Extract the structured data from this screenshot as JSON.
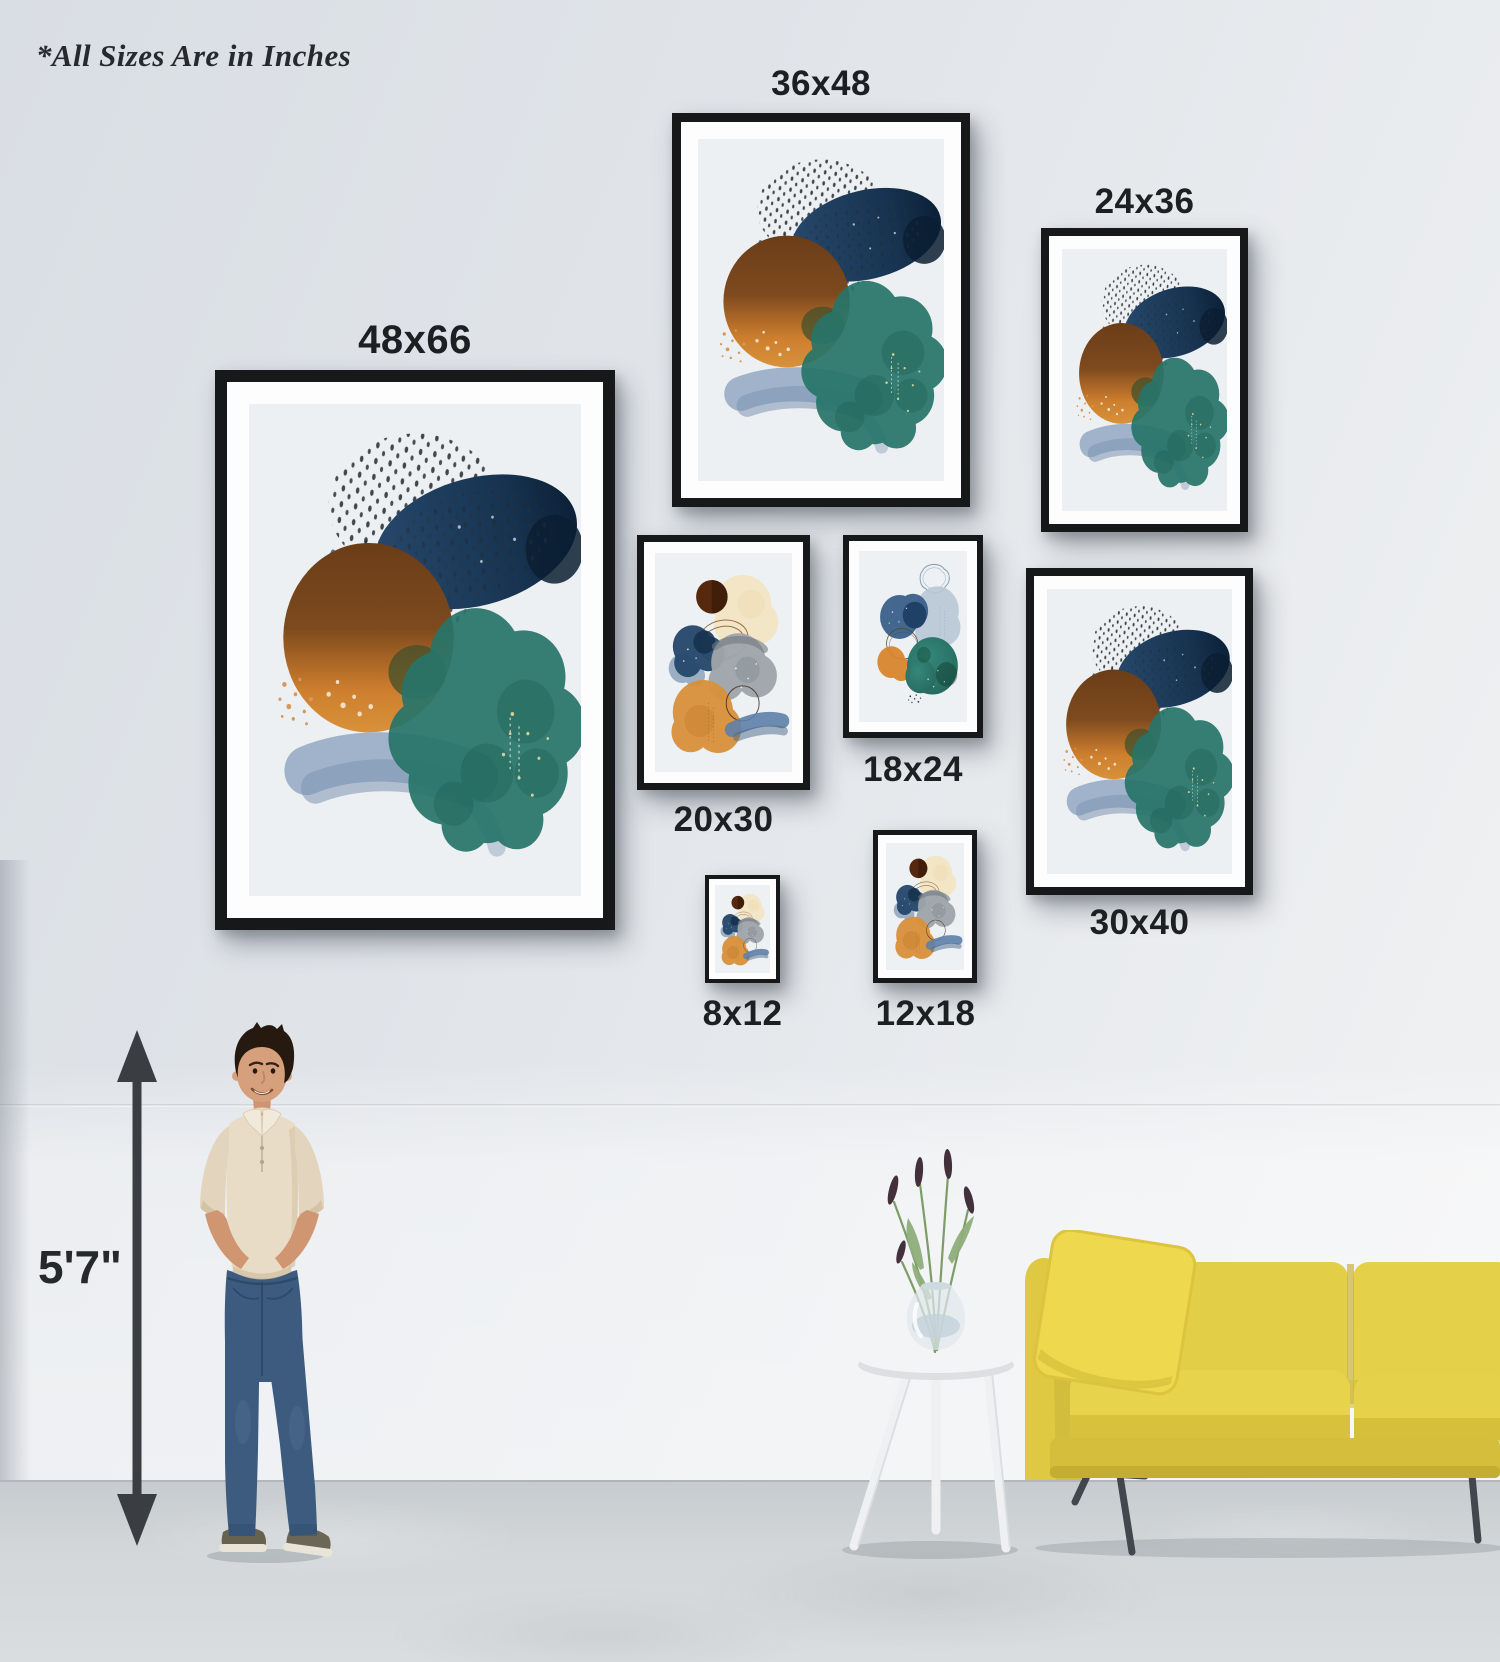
{
  "note": "*All Sizes Are in Inches",
  "frames": [
    {
      "size_label": "48x66",
      "label_position": "above",
      "artwork": "abstract-navy-brown-teal"
    },
    {
      "size_label": "36x48",
      "label_position": "above",
      "artwork": "abstract-navy-brown-teal"
    },
    {
      "size_label": "24x36",
      "label_position": "above",
      "artwork": "abstract-navy-brown-teal"
    },
    {
      "size_label": "20x30",
      "label_position": "below",
      "artwork": "abstract-cream-gray-orange"
    },
    {
      "size_label": "18x24",
      "label_position": "below",
      "artwork": "abstract-blue-orange-teal"
    },
    {
      "size_label": "30x40",
      "label_position": "below",
      "artwork": "abstract-navy-brown-teal"
    },
    {
      "size_label": "8x12",
      "label_position": "below",
      "artwork": "abstract-cream-gray-orange"
    },
    {
      "size_label": "12x18",
      "label_position": "below",
      "artwork": "abstract-cream-gray-orange"
    }
  ],
  "scale_figure": {
    "height_label": "5'7\""
  },
  "colors": {
    "wall": "#e2e6ea",
    "floor": "#d0d4d6",
    "frame_black": "#17181a",
    "mat_white": "#fdfdfd",
    "label_text": "#1d2023",
    "sofa_yellow": "#e3ce48",
    "artwork_navy": "#1c3c5e",
    "artwork_teal": "#27756a",
    "artwork_orange": "#d2812f",
    "artwork_brown": "#74431d",
    "artwork_brush_blue": "#96abc6",
    "shirt_beige": "#e8dcc7",
    "jeans_blue": "#3d5b7e"
  }
}
